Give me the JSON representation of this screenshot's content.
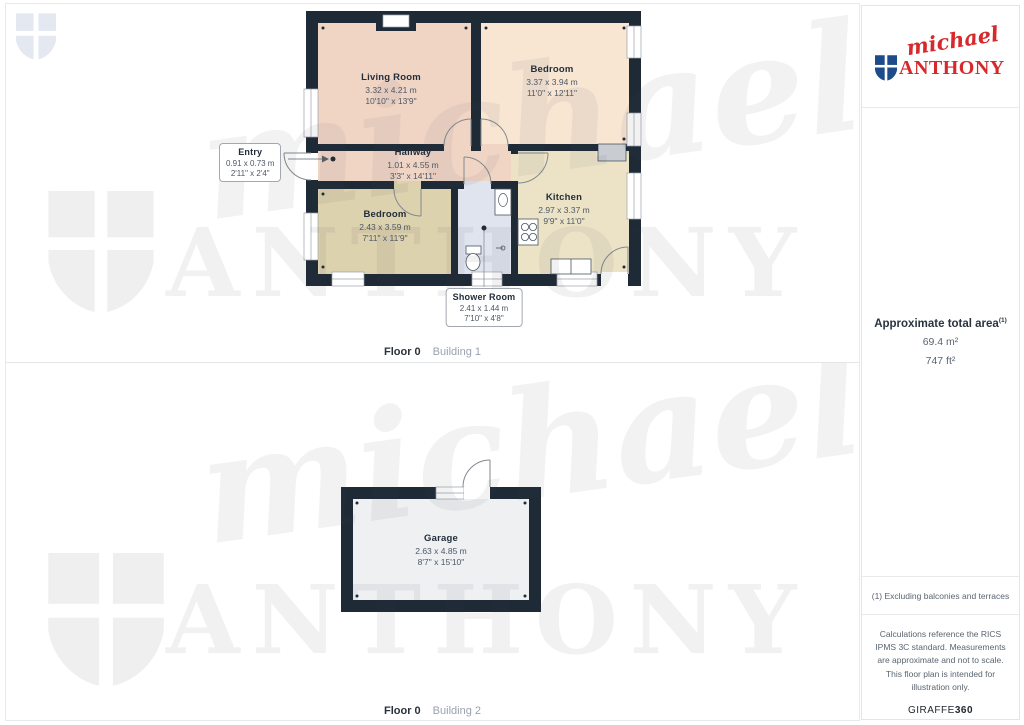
{
  "brand": {
    "name_script": "michael",
    "name_caps": "ANTHONY",
    "logo_red": "#d7292c",
    "shield_blue": "#1e4b8a"
  },
  "floors": [
    {
      "caption_bold": "Floor 0",
      "caption_light": "Building 1",
      "rooms": [
        {
          "name": "Living Room",
          "metric": "3.32 x 4.21 m",
          "imperial": "10'10\" x 13'9\""
        },
        {
          "name": "Bedroom",
          "metric": "3.37 x 3.94 m",
          "imperial": "11'0\" x 12'11\""
        },
        {
          "name": "Hallway",
          "metric": "1.01 x 4.55 m",
          "imperial": "3'3\" x 14'11\""
        },
        {
          "name": "Entry",
          "metric": "0.91 x 0.73 m",
          "imperial": "2'11\" x 2'4\""
        },
        {
          "name": "Bedroom",
          "metric": "2.43 x 3.59 m",
          "imperial": "7'11\" x 11'9\""
        },
        {
          "name": "Kitchen",
          "metric": "2.97 x 3.37 m",
          "imperial": "9'9\" x 11'0\""
        },
        {
          "name": "Shower Room",
          "metric": "2.41 x 1.44 m",
          "imperial": "7'10\" x 4'8\""
        }
      ]
    },
    {
      "caption_bold": "Floor 0",
      "caption_light": "Building 2",
      "rooms": [
        {
          "name": "Garage",
          "metric": "2.63 x 4.85 m",
          "imperial": "8'7\" x 15'10\""
        }
      ]
    }
  ],
  "sidebar": {
    "area_title": "Approximate total area",
    "area_superscript": "(1)",
    "area_m2": "69.4 m²",
    "area_ft2": "747 ft²",
    "note": "(1) Excluding balconies and terraces",
    "disclaimer": "Calculations reference the RICS IPMS 3C standard. Measurements are approximate and not to scale. This floor plan is intended for illustration only.",
    "footer_brand_normal": "GIRAFFE",
    "footer_brand_bold": "360"
  },
  "colors": {
    "walls": "#1f2a37",
    "living_room": "#f0d5c5",
    "bedroom_top": "#f8e6d3",
    "bedroom_bottom": "#ddd2ae",
    "kitchen": "#ece3c7",
    "shower_room": "#dfe4ef",
    "garage": "#eef0f2",
    "watermark": "#efefef"
  }
}
